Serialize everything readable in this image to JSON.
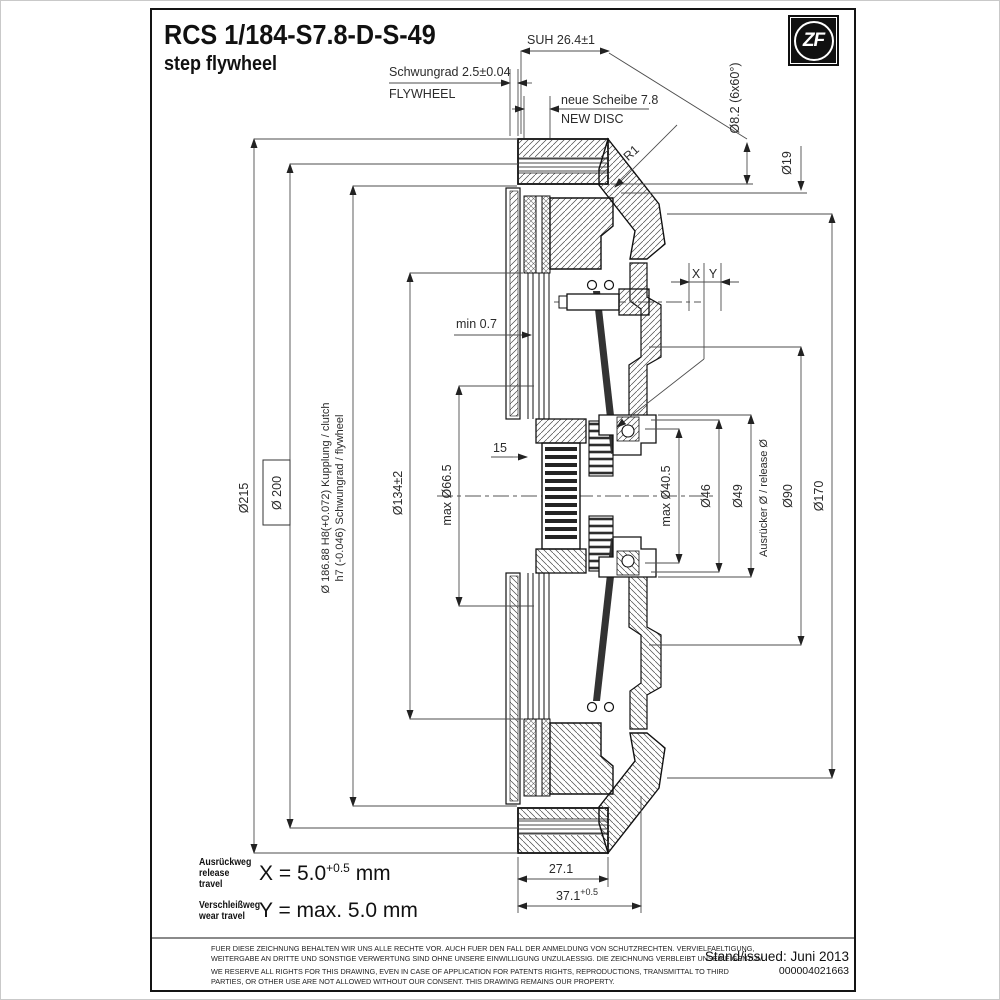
{
  "title": {
    "code": "RCS 1/184-S7.8-D-S-49",
    "subtitle": "step flywheel"
  },
  "logo": {
    "text": "ZF"
  },
  "callouts": {
    "suh": "SUH 26.4±1",
    "flywheel_de": "Schwungrad 2.5±0.04",
    "flywheel_en": "FLYWHEEL",
    "new_disc_de": "neue Scheibe 7.8",
    "new_disc_en": "NEW DISC",
    "bolt_holes": "Ø8.2 (6x60°)",
    "d19": "Ø19",
    "r1": "R1",
    "min_gap": "min 0.7",
    "x_label": "X",
    "y_label": "Y",
    "d215": "Ø215",
    "d200": "Ø 200",
    "fit_line1": "Ø 186.88 H8(+0.072) Kupplung / clutch",
    "fit_line2": "h7 (-0.046) Schwungrad / flywheel",
    "d134": "Ø134±2",
    "d66": "max Ø66.5",
    "hub_note": "15",
    "d40": "max Ø40.5",
    "d46": "Ø46",
    "d49": "Ø49",
    "release_label": "Ausrücker Ø / release Ø",
    "d90": "Ø90",
    "d170": "Ø170",
    "w271": "27.1",
    "w371": "37.1",
    "w371_tol": "+0.5"
  },
  "notes": {
    "x_label_de": "Ausrückweg",
    "x_label_en": "release travel",
    "x_value": "X = 5.0",
    "x_tol": "+0.5",
    "x_unit": "mm",
    "y_label_de": "Verschleißweg",
    "y_label_en": "wear travel",
    "y_value": "Y = max. 5.0 mm"
  },
  "legal": {
    "de1": "FUER DIESE ZEICHNUNG BEHALTEN WIR UNS ALLE RECHTE VOR. AUCH FUER DEN FALL DER ANMELDUNG VON SCHUTZRECHTEN. VERVIELFAELTIGUNG,",
    "de2": "WEITERGABE AN DRITTE UND SONSTIGE VERWERTUNG SIND OHNE UNSERE EINWILLIGUNG UNZULAESSIG. DIE ZEICHNUNG VERBLEIBT UNSER EIGENTUM.",
    "en1": "WE RESERVE ALL RIGHTS FOR THIS DRAWING, EVEN IN CASE OF APPLICATION FOR PATENTS RIGHTS, REPRODUCTIONS, TRANSMITTAL TO THIRD",
    "en2": "PARTIES, OR OTHER USE ARE NOT ALLOWED WITHOUT OUR CONSENT. THIS DRAWING REMAINS OUR PROPERTY."
  },
  "footer": {
    "issued": "Stand/issued: Juni 2013",
    "number": "000004021663"
  }
}
